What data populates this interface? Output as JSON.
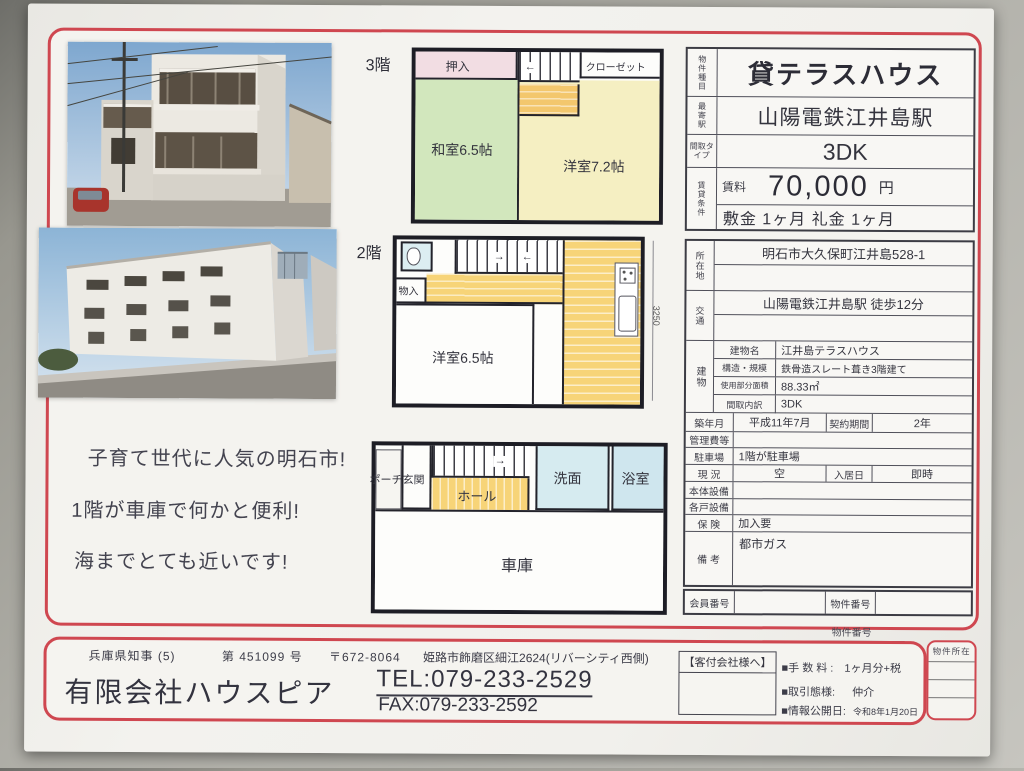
{
  "colors": {
    "frame_red": "#cf4750",
    "tatami_green": "#d2e7bd",
    "room_cream": "#f5efc2",
    "hall_yellow": "#f7d478",
    "wet_blue": "#d6ebf0",
    "closet_pink": "#f2dde3"
  },
  "price_box": {
    "property_type_label": "物件種目",
    "property_type": "貸テラスハウス",
    "station_label": "最寄駅",
    "station": "山陽電鉄江井島駅",
    "plan_label": "間取タイプ",
    "plan": "3DK",
    "terms_label": "賃貸条件",
    "rent_label": "賃料",
    "rent": "70,000",
    "rent_unit": "円",
    "deposit": "敷金 1ヶ月 礼金  1ヶ月"
  },
  "detail_table": {
    "location_label": "所在地",
    "location": "明石市大久保町江井島528-1",
    "access_label": "交通",
    "access": "山陽電鉄江井島駅 徒歩12分",
    "building_label": "建物",
    "building_name_label": "建物名",
    "building_name": "江井島テラスハウス",
    "structure_label": "構造・規模",
    "structure": "鉄骨造スレート葺き3階建て",
    "area_label": "使用部分面積",
    "area": "88.33㎡",
    "layout_label": "間取内訳",
    "layout": "3DK",
    "built_label": "築年月",
    "built": "平成11年7月",
    "term_label": "契約期間",
    "term": "2年",
    "mgmt_label": "管理費等",
    "mgmt": "",
    "parking_label": "駐車場",
    "parking": "1階が駐車場",
    "status_label": "現 況",
    "status": "空",
    "movein_label": "入居日",
    "movein": "即時",
    "main_equip_label": "本体設備",
    "main_equip": "",
    "unit_equip_label": "各戸設備",
    "unit_equip": "",
    "insurance_label": "保 険",
    "insurance": "加入要",
    "notes_label": "備 考",
    "notes": "都市ガス",
    "member_no_label": "会員番号",
    "member_no": "",
    "property_no_label": "物件番号",
    "property_no": ""
  },
  "floorplans": {
    "f3": {
      "floor": "3階",
      "oshiire": "押入",
      "closet": "クローゼット",
      "washitsu": "和室6.5帖",
      "youshitsu": "洋室7.2帖"
    },
    "f2": {
      "floor": "2階",
      "monoire": "物入",
      "youshitsu": "洋室6.5帖",
      "dimension": "3250"
    },
    "f1": {
      "porch": "ポーチ玄関",
      "hall": "ホール",
      "senmen": "洗面",
      "bath": "浴室",
      "garage": "車庫"
    }
  },
  "catchcopy": {
    "line1": "子育て世代に人気の明石市!",
    "line2": "1階が車庫で何かと便利!",
    "line3": "海までとても近いです!"
  },
  "footer": {
    "property_no_top": "物件番号",
    "governor": "兵庫県知事 (5)",
    "license_no": "第 451099 号",
    "postal": "〒672-8064",
    "address": "姫路市飾磨区細江2624(リバーシティ西側)",
    "company": "有限会社ハウスピア",
    "tel": "TEL:079-233-2529",
    "fax": "FAX:079-233-2592",
    "to_agents": "【客付会社様へ】",
    "fee_label": "■手 数 料 :",
    "fee": "1ヶ月分+税",
    "deal_label": "■取引態様:",
    "deal": "仲介",
    "published_label": "■情報公開日:",
    "published": "令和8年1月20日",
    "property_loc_label": "物件所在"
  }
}
